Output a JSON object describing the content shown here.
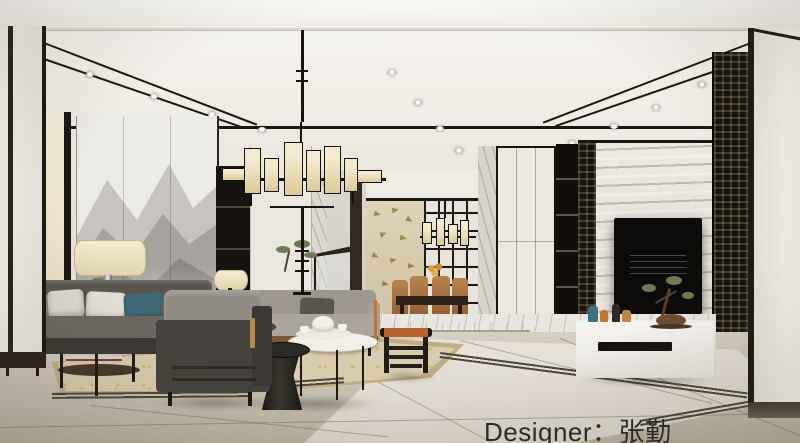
{
  "overlay": {
    "designer_label": "Designer：张勤"
  },
  "scene": {
    "description": "Photorealistic rendering of a new-Chinese-style living room: ink-wash mountain mural and gray sofa on the left, rectangular fabric-shade chandelier, dining room beyond the steps, travertine marble TV wall flanked by dark fretwork lattice screens, white low TV console, beige rug over marble tile floor"
  },
  "palette": {
    "ceiling": "#f4f1ec",
    "trim": "#1b1712",
    "wall": "#ece8e0",
    "marble": "#bcab8f",
    "lattice": "#17130d",
    "sofa": "#5a564f",
    "teal": "#3f6a78",
    "wood": "#b5773d",
    "stool": "#b6602c",
    "rug": "#d9ccae",
    "floor": "#cac2b3",
    "shade": "#e2d4ae",
    "console": "#f7f5f1",
    "text": "#2c2b29"
  }
}
